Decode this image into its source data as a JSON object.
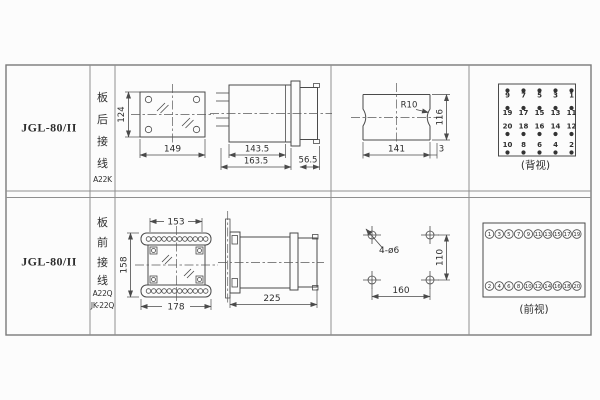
{
  "colors": {
    "line": "#4a4a4a",
    "grid": "#8f8f8f",
    "text": "#2e2e2e",
    "background": "#fcfcfc"
  },
  "rows": [
    {
      "model": "JGL-80/II",
      "wiring_chars": [
        "板",
        "后",
        "接",
        "线"
      ],
      "wiring_codes": [
        "A22K"
      ],
      "front_view": {
        "height_dim": "124",
        "width_dim": "149"
      },
      "side_view": {
        "case_dim": "143.5",
        "total_dim": "163.5",
        "rear_dim": "56.5"
      },
      "cutout_view": {
        "radius_label": "R10",
        "height_dim": "116",
        "width_dim": "141",
        "edge_dim": "3"
      },
      "terminal_view": {
        "caption": "(背视)",
        "rows": [
          {
            "dot_position": "above",
            "labels": [
              "9",
              "7",
              "5",
              "3",
              "1"
            ]
          },
          {
            "dot_position": "above",
            "labels": [
              "19",
              "17",
              "15",
              "13",
              "11"
            ]
          },
          {
            "dot_position": "below",
            "labels": [
              "20",
              "18",
              "16",
              "14",
              "12"
            ]
          },
          {
            "dot_position": "below",
            "labels": [
              "10",
              "8",
              "6",
              "4",
              "2"
            ]
          }
        ]
      }
    },
    {
      "model": "JGL-80/II",
      "wiring_chars": [
        "板",
        "前",
        "接",
        "线"
      ],
      "wiring_codes": [
        "A22Q",
        "JK-22Q"
      ],
      "front_view": {
        "top_width_dim": "153",
        "height_dim": "158",
        "width_dim": "178"
      },
      "side_view": {
        "depth_dim": "225"
      },
      "drill_view": {
        "holes_label": "4-ø6",
        "height_dim": "110",
        "width_dim": "160"
      },
      "terminal_view": {
        "caption": "(前视)",
        "top_row": [
          "1",
          "3",
          "5",
          "7",
          "9",
          "11",
          "13",
          "15",
          "17",
          "19"
        ],
        "bottom_row": [
          "2",
          "4",
          "6",
          "8",
          "10",
          "12",
          "14",
          "16",
          "18",
          "20"
        ]
      }
    }
  ]
}
